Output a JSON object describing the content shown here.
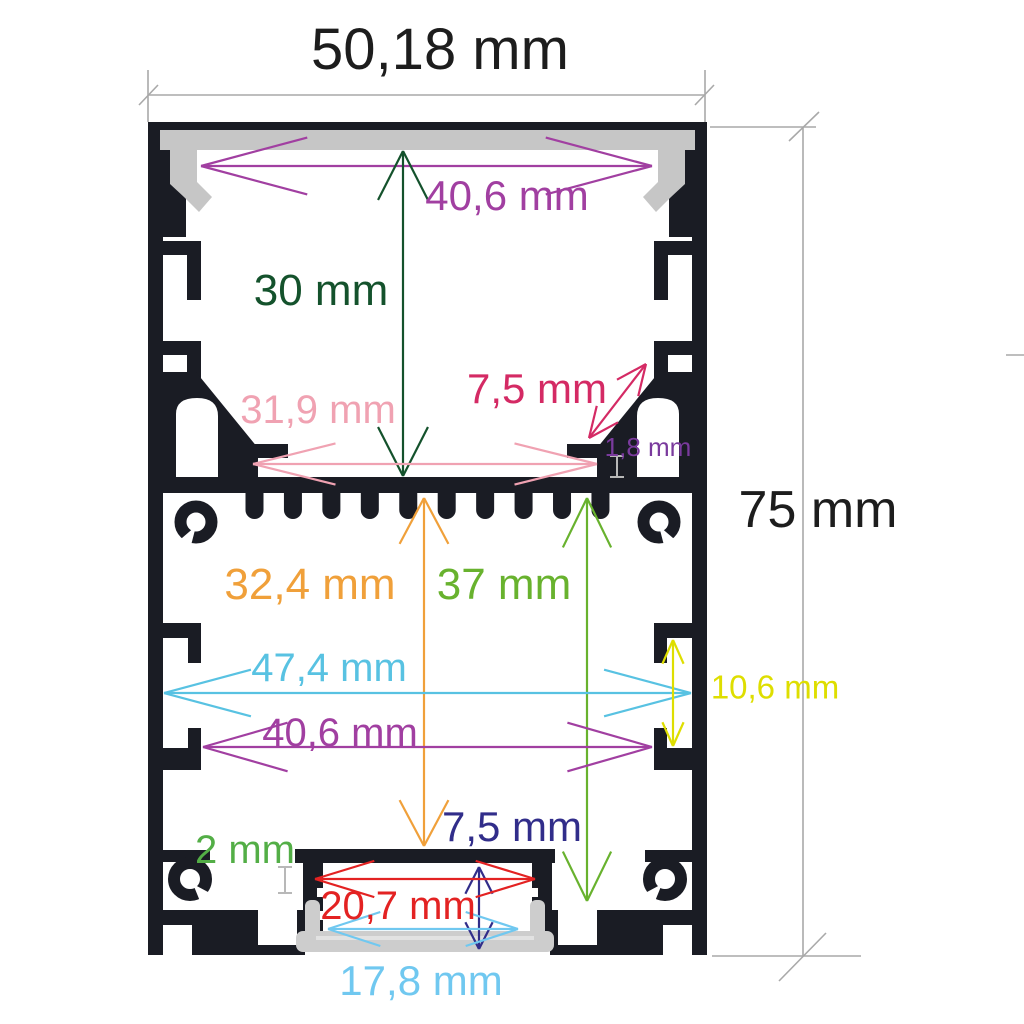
{
  "diagram_title": "",
  "background_color": "#ffffff",
  "profile": {
    "body_color": "#1a1c24",
    "diffuser_color": "#c6c6c6",
    "bottom_diffuser_color": "#cdcdcd",
    "construction_line_color": "#a9a9a9",
    "tick_color": "#b8b8b8"
  },
  "dimensions": {
    "overall_width": {
      "label": "50,18 mm",
      "color": "#1d1d1d"
    },
    "overall_height": {
      "label": "75 mm",
      "color": "#1d1d1d"
    },
    "top_inner_width": {
      "label": "40,6 mm",
      "color": "#a13fa1"
    },
    "upper_chamber_height": {
      "label": "30 mm",
      "color": "#14522c"
    },
    "gusset_length": {
      "label": "7,5 mm",
      "color": "#d42a64"
    },
    "upper_inner_width": {
      "label": "31,9 mm",
      "color": "#f0a2b2"
    },
    "foot_gap": {
      "label": "1,8 mm",
      "color": "#7a3a9d"
    },
    "lower_chamber_height": {
      "label": "32,4 mm",
      "color": "#f0a03a"
    },
    "lower_total_height": {
      "label": "37 mm",
      "color": "#68b22e"
    },
    "lower_inner_width": {
      "label": "47,4 mm",
      "color": "#58c2e2"
    },
    "channel_slot_width": {
      "label": "40,6 mm",
      "color": "#a13fa1"
    },
    "side_slot_height": {
      "label": "10,6 mm",
      "color": "#dede00"
    },
    "led_channel_height": {
      "label": "7,5 mm",
      "color": "#312d8a"
    },
    "web_thickness": {
      "label": "2 mm",
      "color": "#53ae46"
    },
    "led_channel_width": {
      "label": "20,7 mm",
      "color": "#e32222"
    },
    "diffuser_width": {
      "label": "17,8 mm",
      "color": "#70c8f0"
    }
  }
}
